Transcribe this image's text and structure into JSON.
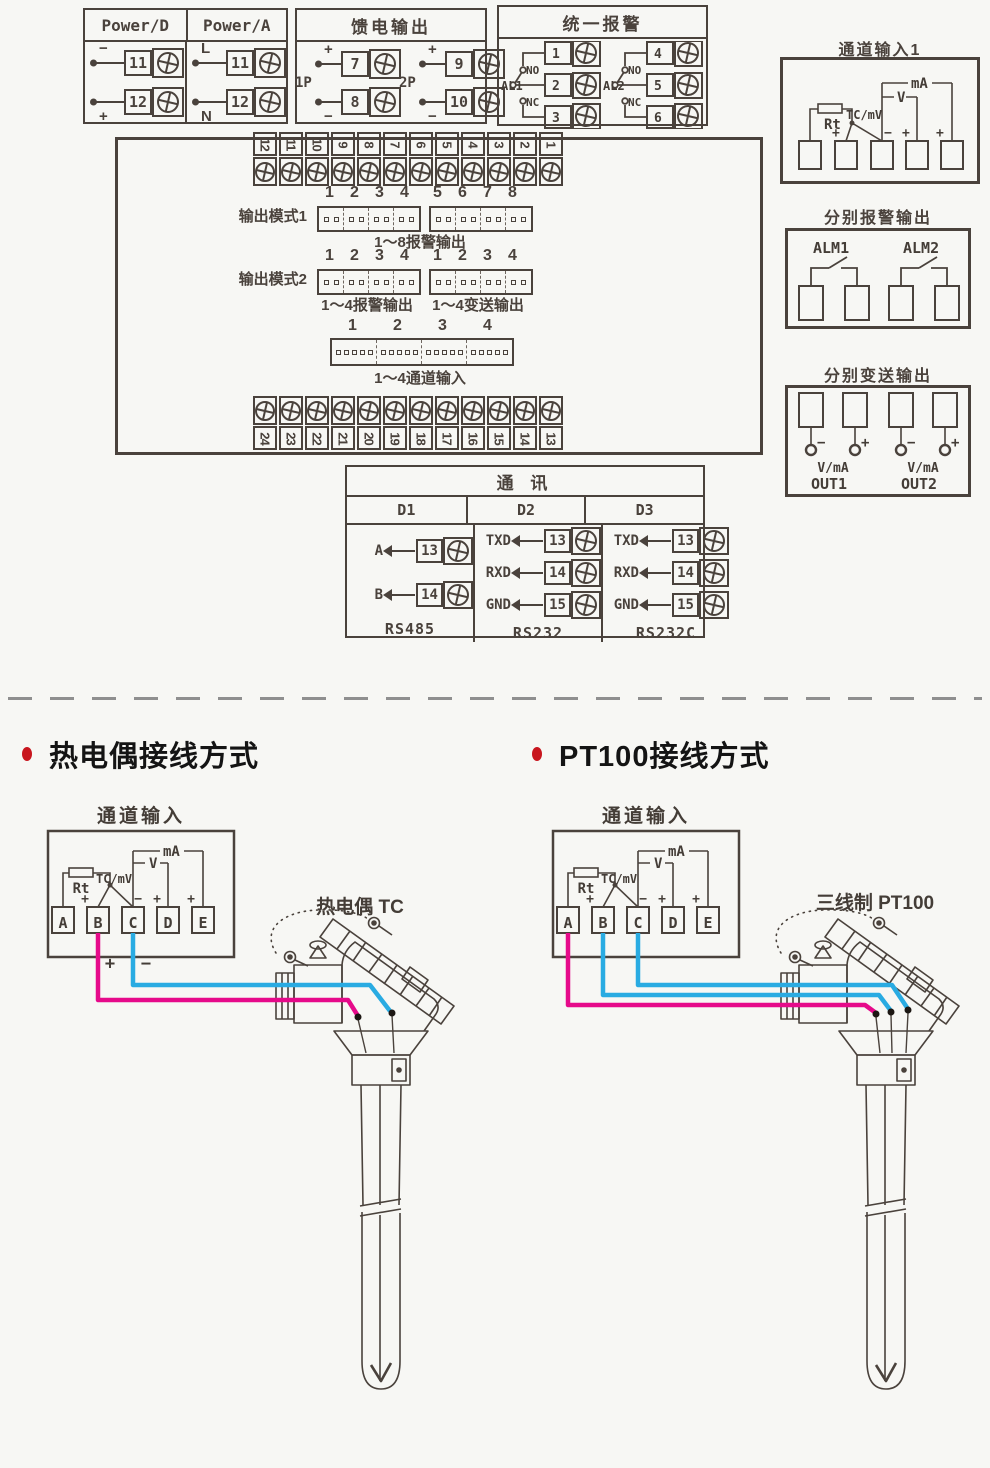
{
  "palette": {
    "ink": "#4a423c",
    "pink": "#e60a8a",
    "blue": "#29abe2",
    "accent_red": "#c8161e",
    "background": "#f7f7f4"
  },
  "power_box": {
    "col1_title": "Power/D",
    "col2_title": "Power/A",
    "d_rows": [
      {
        "sign": "−",
        "num": "11"
      },
      {
        "sign": "+",
        "num": "12"
      }
    ],
    "a_rows": [
      {
        "sign": "L",
        "num": "11"
      },
      {
        "sign": "N",
        "num": "12"
      }
    ]
  },
  "feed_box": {
    "title": "馈电输出",
    "g1_label": "1P",
    "g2_label": "2P",
    "g1_rows": [
      {
        "sign": "+",
        "num": "7"
      },
      {
        "sign": "−",
        "num": "8"
      }
    ],
    "g2_rows": [
      {
        "sign": "+",
        "num": "9"
      },
      {
        "sign": "−",
        "num": "10"
      }
    ]
  },
  "alarm_box": {
    "title": "统一报警",
    "groups": [
      {
        "label": "AL1",
        "no": "NO",
        "nc": "NC",
        "t1": "1",
        "t2": "2",
        "t3": "3"
      },
      {
        "label": "AL2",
        "no": "NO",
        "nc": "NC",
        "t1": "4",
        "t2": "5",
        "t3": "6"
      }
    ]
  },
  "channel1_box": {
    "title": "通道输入1",
    "rt": "Rt",
    "tc": "TC/mV",
    "v": "V",
    "ma": "mA",
    "s_plus_b": "+",
    "s_minus_c": "−",
    "s_plus_d": "+",
    "s_plus_e": "+"
  },
  "panel": {
    "top_strip": [
      "12",
      "11",
      "10",
      "9",
      "8",
      "7",
      "6",
      "5",
      "4",
      "3",
      "2",
      "1"
    ],
    "bottom_strip": [
      "24",
      "23",
      "22",
      "21",
      "20",
      "19",
      "18",
      "17",
      "16",
      "15",
      "14",
      "13"
    ],
    "mode1": {
      "label": "输出模式1",
      "nums_left": [
        "1",
        "2",
        "3",
        "4"
      ],
      "nums_right": [
        "5",
        "6",
        "7",
        "8"
      ],
      "caption": "1～8报警输出"
    },
    "mode2": {
      "label": "输出模式2",
      "nums_left": [
        "1",
        "2",
        "3",
        "4"
      ],
      "nums_right": [
        "1",
        "2",
        "3",
        "4"
      ],
      "caption_left": "1～4报警输出",
      "caption_right": "1～4变送输出"
    },
    "chconn": {
      "nums": [
        "1",
        "2",
        "3",
        "4"
      ],
      "caption": "1～4通道输入"
    }
  },
  "alarm_out": {
    "title": "分别报警输出",
    "g1": "ALM1",
    "g2": "ALM2"
  },
  "trans_out": {
    "title": "分别变送输出",
    "minus": "−",
    "plus": "+",
    "vma": "V/mA",
    "out1": "OUT1",
    "out2": "OUT2"
  },
  "comm": {
    "title": "通 讯",
    "cols": [
      {
        "name": "D1",
        "rows": [
          {
            "label": "A",
            "num": "13"
          },
          {
            "label": "B",
            "num": "14"
          }
        ],
        "foot": "RS485"
      },
      {
        "name": "D2",
        "rows": [
          {
            "label": "TXD",
            "num": "13"
          },
          {
            "label": "RXD",
            "num": "14"
          },
          {
            "label": "GND",
            "num": "15"
          }
        ],
        "foot": "RS232"
      },
      {
        "name": "D3",
        "rows": [
          {
            "label": "TXD",
            "num": "13"
          },
          {
            "label": "RXD",
            "num": "14"
          },
          {
            "label": "GND",
            "num": "15"
          }
        ],
        "foot": "RS232C"
      }
    ]
  },
  "tc_section": {
    "heading": "热电偶接线方式",
    "input_title": "通道输入",
    "sensor_label": "热电偶 TC",
    "rt": "Rt",
    "tc": "TC/mV",
    "v": "V",
    "ma": "mA",
    "terms": [
      "A",
      "B",
      "C",
      "D",
      "E"
    ],
    "s_plus_b": "+",
    "s_minus_c": "−",
    "s_plus_d": "+",
    "s_plus_e": "+",
    "wire_plus": "+",
    "wire_minus": "−"
  },
  "pt_section": {
    "heading": "PT100接线方式",
    "input_title": "通道输入",
    "sensor_label": "三线制 PT100",
    "rt": "Rt",
    "tc": "TC/mV",
    "v": "V",
    "ma": "mA",
    "terms": [
      "A",
      "B",
      "C",
      "D",
      "E"
    ],
    "s_plus_b": "+",
    "s_minus_c": "−",
    "s_plus_d": "+",
    "s_plus_e": "+"
  }
}
